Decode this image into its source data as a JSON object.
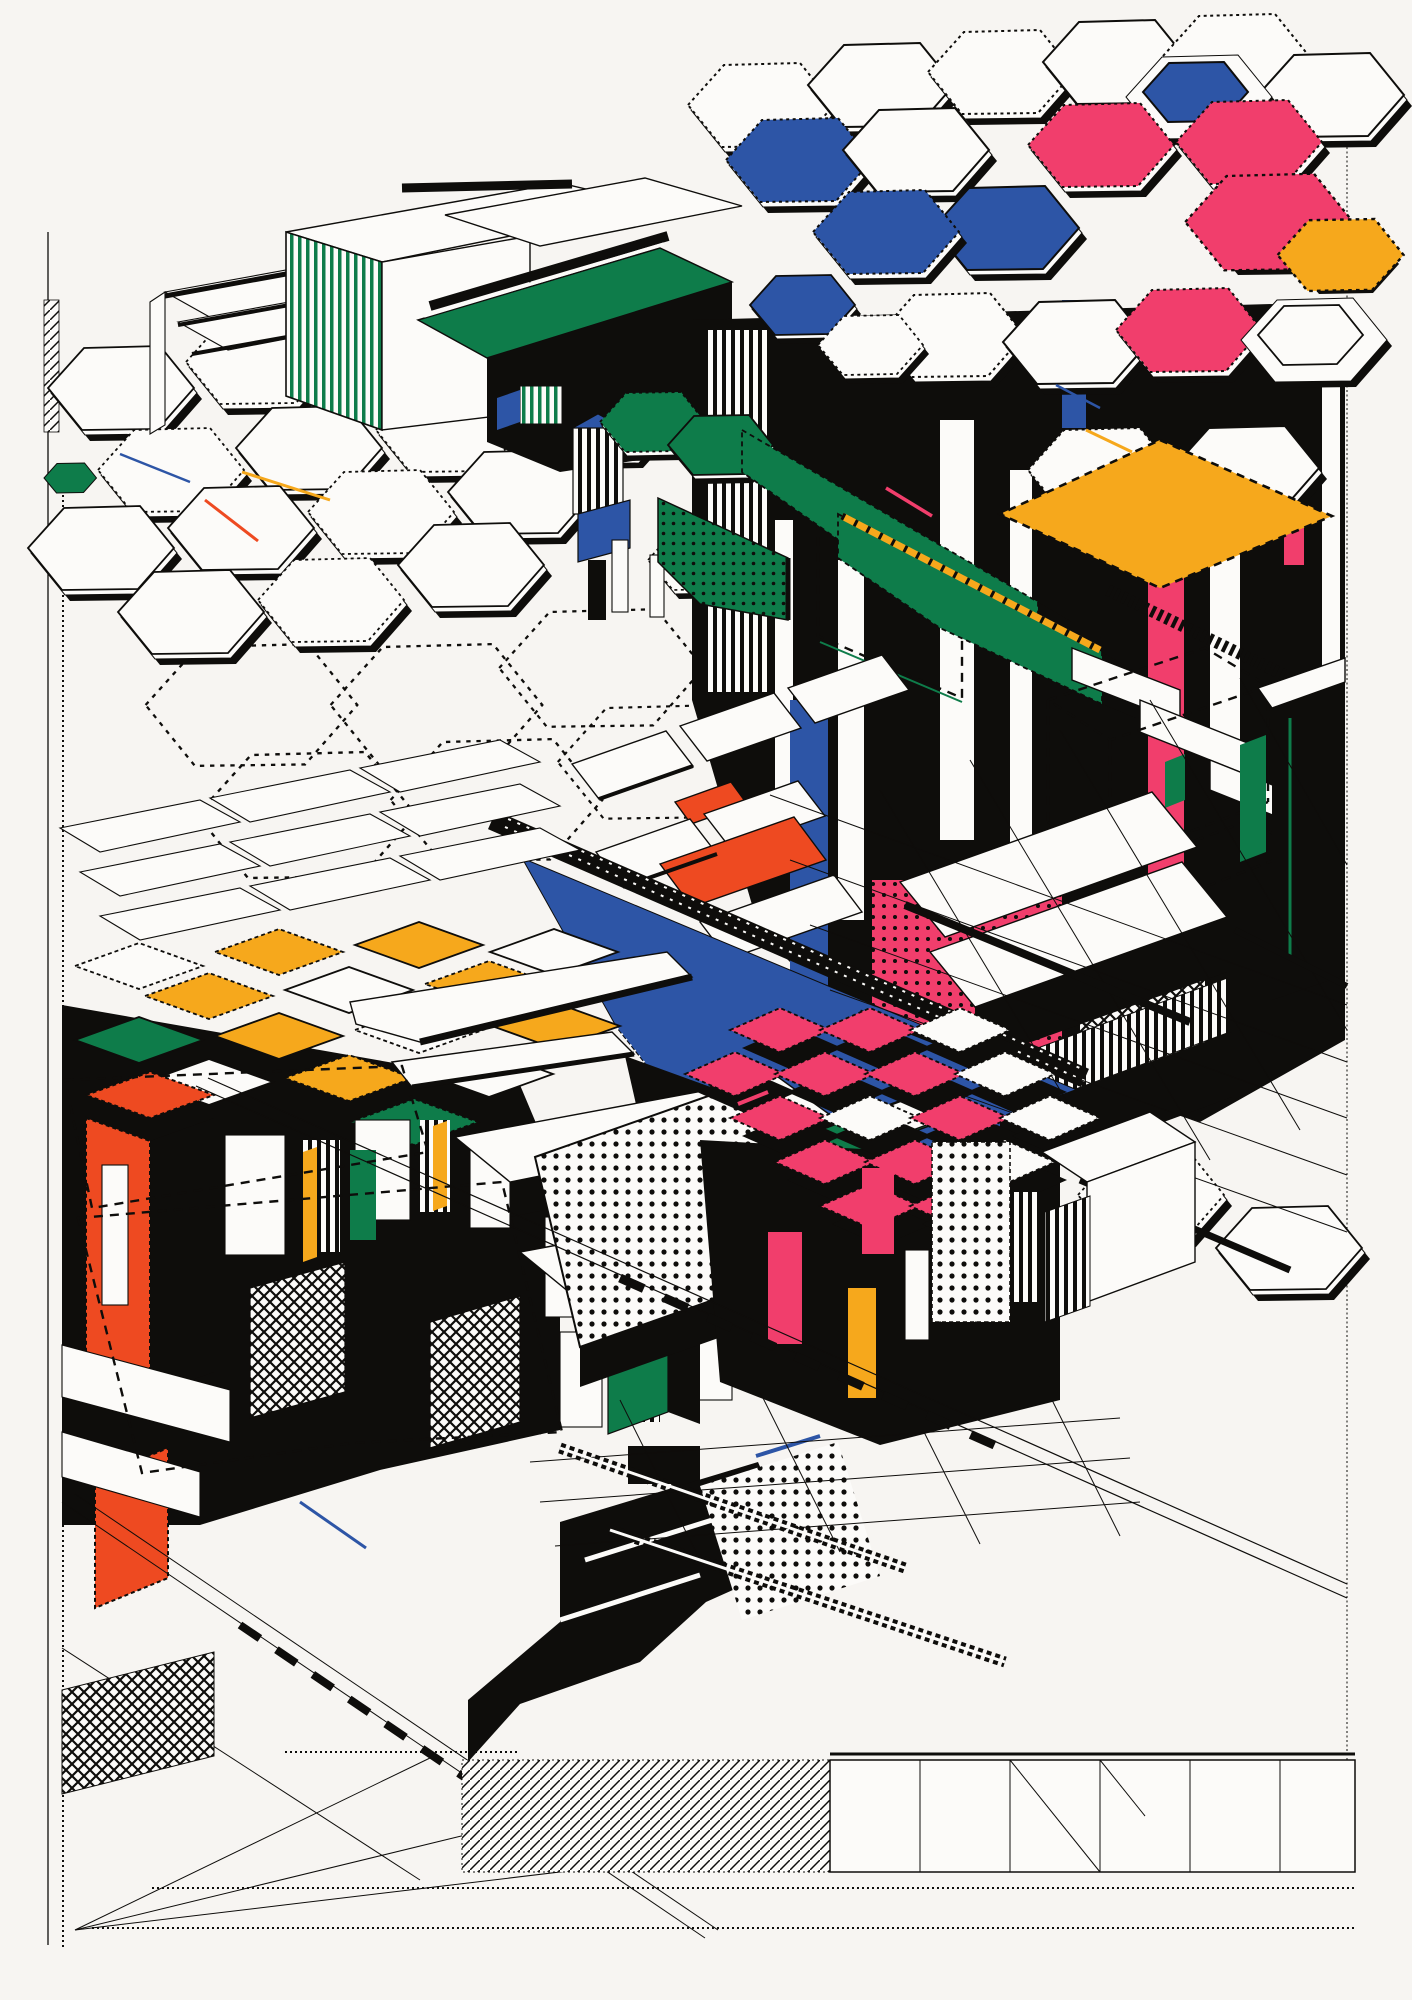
{
  "artwork": {
    "label": "Axonometric block-city illustration in pop-art line style",
    "canvas": {
      "width": 1412,
      "height": 2000
    },
    "background": "#F7F5F2",
    "palette": {
      "ink": "#0E0D0B",
      "paper": "#FCFBF9",
      "green": "#0E7C4A",
      "blue": "#2D55A6",
      "pink": "#F13E6C",
      "orange": "#EE4A21",
      "yellow": "#F6A81C"
    },
    "elements": [
      "top-left-slab-hall",
      "hexagon-tile-plain",
      "hexagon-tower-cluster",
      "green-wedge-terminal",
      "amber-roof-diamond",
      "blue-grandstand-wall",
      "roof-panel-field",
      "yellow-top-tower-block",
      "vermilion-tower",
      "terrace-table-building",
      "pink-roof-cluster",
      "halftone-dotted-slab",
      "ghost-dashed-plots",
      "road-grid",
      "bottom-rail-strips",
      "corner-grid-plate",
      "ink-ribbon-stair"
    ]
  }
}
